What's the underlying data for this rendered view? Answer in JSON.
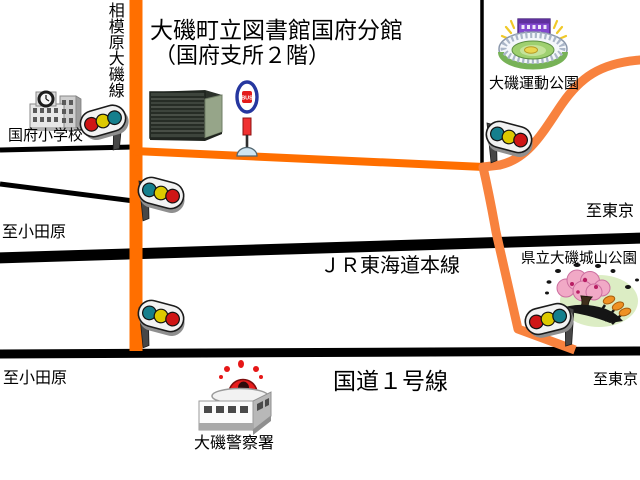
{
  "map": {
    "title_line1": "大磯町立図書館国府分館",
    "title_line2": "（国府支所２階）",
    "roads": {
      "sagamihara_oiso": {
        "label": "相模原大磯線",
        "color": "#ff6f00"
      },
      "jr_tokaido_main_line": {
        "label": "ＪＲ東海道本線",
        "color": "#000000"
      },
      "route_1": {
        "label": "国道１号線",
        "color": "#000000"
      }
    },
    "directions": {
      "upper_right_to_tokyo": "至東京",
      "upper_left_to_odawara": "至小田原",
      "lower_left_to_odawara": "至小田原",
      "lower_right_to_tokyo": "至東京"
    },
    "landmarks": {
      "elementary_school": "国府小学校",
      "sports_park": "大磯運動公園",
      "shiroyama_park": "県立大磯城山公園",
      "police_station": "大磯警察署",
      "bus_stop_sign": "BUS"
    },
    "colors": {
      "road_orange": "#ff6f00",
      "road_curve_orange": "#f8823e",
      "rail_black": "#000000",
      "background": "#ffffff",
      "signal_red": "#cf1515",
      "signal_yellow": "#ddc900",
      "signal_blue": "#157f8d",
      "bus_oval_blue": "#26379f",
      "police_red": "#e81c1c",
      "blossom_pink": "#f1a9c6",
      "park_green": "#dcedc4"
    }
  }
}
